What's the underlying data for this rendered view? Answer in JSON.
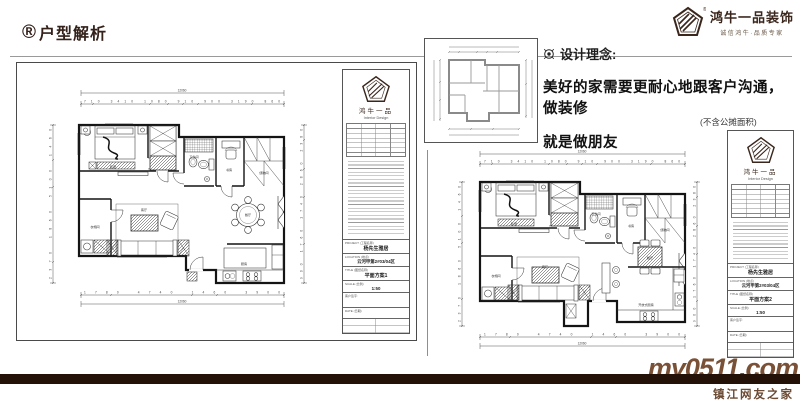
{
  "header": {
    "registered_mark": "®",
    "title": "户型解析"
  },
  "brand": {
    "reg": "®",
    "name": "鸿牛一品装饰",
    "slogan": "诚信鸿牛·品质专家"
  },
  "concept": {
    "heading": "设计理念:",
    "line1": "美好的家需要更耐心地跟客户沟通，做装修",
    "line2": "就是做朋友",
    "note": "(不含公摊面积)"
  },
  "dims": {
    "top_total": "12060",
    "top_segments": "710 3410 1080 910 900 3190 860",
    "bottom_segments": "1780 4740 1460 3900",
    "bottom_total": "12060",
    "left_segments": "2370 1860 5100 1460",
    "right_segments": "900 1760 1740 2860 2380"
  },
  "plan1_rooms": {
    "bedroom": "卧室",
    "living": "客厅",
    "dining": "餐厅",
    "kitchen": "厨房",
    "bath": "卫生间",
    "study": "书房",
    "storage": "储物间",
    "cloak": "衣帽间"
  },
  "plan2_rooms": {
    "bedroom": "卧室",
    "living": "客厅",
    "dining": "餐厅",
    "kitchen": "开放式厨房",
    "bath": "卫生间",
    "study": "书房",
    "storage": "储物间",
    "cloak": "衣帽间"
  },
  "titleblock1": {
    "logo_cn": "鸿牛一品",
    "logo_en": "Interior Design",
    "project_label": "PROJECT (工程名称)",
    "project": "杨先生雅居",
    "location_label": "LOCATION (地点)",
    "location": "云河甲第2#03/04区",
    "title_label": "TITLE (图纸名称)",
    "title": "平面方案1",
    "scale_label": "SCALE (比例)",
    "scale": "1:50",
    "sign_label": "客户签字:",
    "date_label": "DATE (日期)"
  },
  "titleblock2": {
    "logo_cn": "鸿牛一品",
    "logo_en": "Interior Design",
    "project_label": "PROJECT (工程名称)",
    "project": "杨先生雅居",
    "location_label": "LOCATION (地点)",
    "location": "云河甲第2#03/04区",
    "title_label": "TITLE (图纸名称)",
    "title": "平面方案2",
    "scale_label": "SCALE (比例)",
    "scale": "1:50",
    "sign_label": "客户签字:",
    "date_label": "DATE (日期)"
  },
  "watermark": {
    "site": "my0511.com",
    "name": "镇江网友之家"
  },
  "colors": {
    "accent": "#33211a",
    "bar": "#241208",
    "watermark": "#6d4a33"
  }
}
